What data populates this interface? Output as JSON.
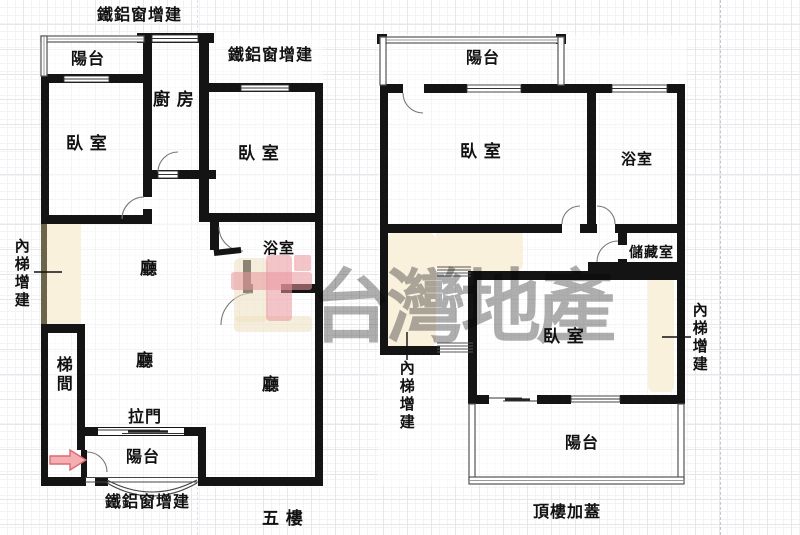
{
  "watermark": {
    "text": "台灣地產"
  },
  "colors": {
    "wall": "#141414",
    "beige_fill": "#faf1dd",
    "olive_border": "#6b654c",
    "arrow_fill": "#f5aeb2",
    "arrow_stroke": "#d96b72",
    "logo_red": "#e9959c",
    "logo_beige": "#eee0bf",
    "watermark_gray": "#5d5d60"
  },
  "left_plan": {
    "floor_label": "五 樓",
    "window_note_top": "鐵鋁窗增建",
    "window_note_right": "鐵鋁窗增建",
    "window_note_bottom": "鐵鋁窗增建",
    "inner_stairs_note": "內梯增建",
    "balcony_top": "陽台",
    "kitchen": "廚 房",
    "bedroom_left": "臥 室",
    "bedroom_right": "臥 室",
    "bathroom": "浴室",
    "hall_upper": "廳",
    "hall_middle": "廳",
    "hall_lower": "廳",
    "stairwell": "梯間",
    "sliding_door": "拉門",
    "balcony_bottom": "陽台"
  },
  "right_plan": {
    "floor_label": "頂樓加蓋",
    "balcony_top": "陽台",
    "bedroom_top": "臥 室",
    "bathroom": "浴室",
    "storage": "儲藏室",
    "bedroom_bottom": "臥 室",
    "inner_stairs_note_left": "內梯增建",
    "inner_stairs_note_right": "內梯增建",
    "balcony_bottom": "陽台"
  }
}
